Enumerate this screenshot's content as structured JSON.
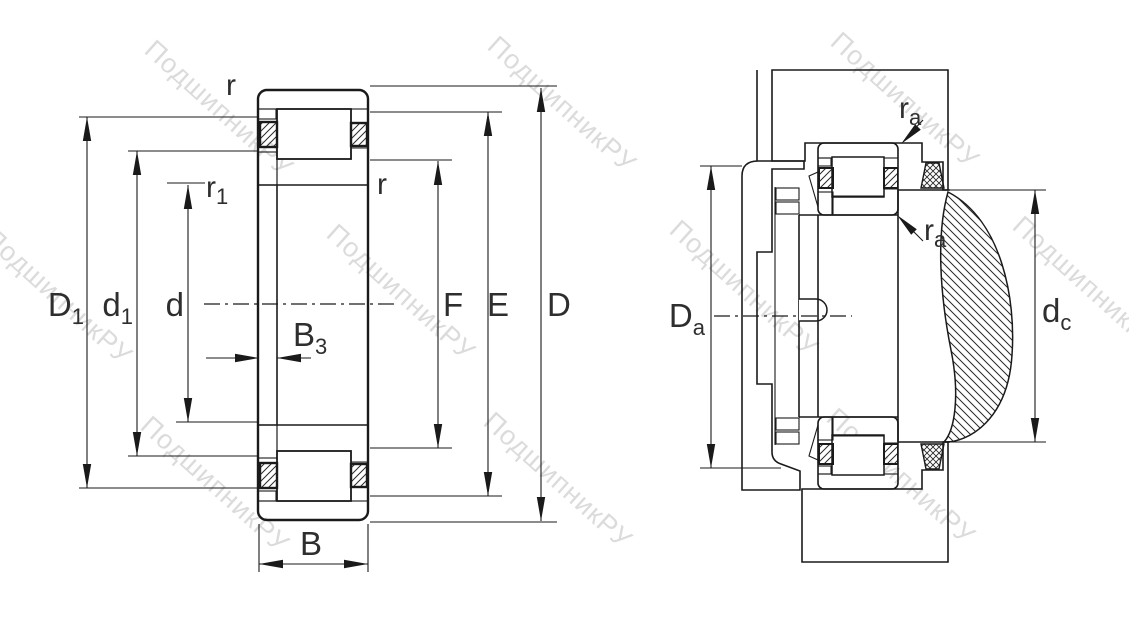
{
  "watermark": {
    "text": "ПодшипникРУ"
  },
  "left_view": {
    "labels": {
      "r_top": {
        "main": "r",
        "sub": ""
      },
      "r1": {
        "main": "r",
        "sub": "1"
      },
      "r_right": {
        "main": "r",
        "sub": ""
      },
      "D1": {
        "main": "D",
        "sub": "1"
      },
      "d1": {
        "main": "d",
        "sub": "1"
      },
      "d": {
        "main": "d",
        "sub": ""
      },
      "B3": {
        "main": "B",
        "sub": "3"
      },
      "B": {
        "main": "B",
        "sub": ""
      },
      "F": {
        "main": "F",
        "sub": ""
      },
      "E": {
        "main": "E",
        "sub": ""
      },
      "D": {
        "main": "D",
        "sub": ""
      }
    }
  },
  "right_view": {
    "labels": {
      "ra_top": {
        "main": "r",
        "sub": "a"
      },
      "ra_bottom": {
        "main": "r",
        "sub": "a"
      },
      "Da": {
        "main": "D",
        "sub": "a"
      },
      "dc": {
        "main": "d",
        "sub": "c"
      }
    }
  }
}
